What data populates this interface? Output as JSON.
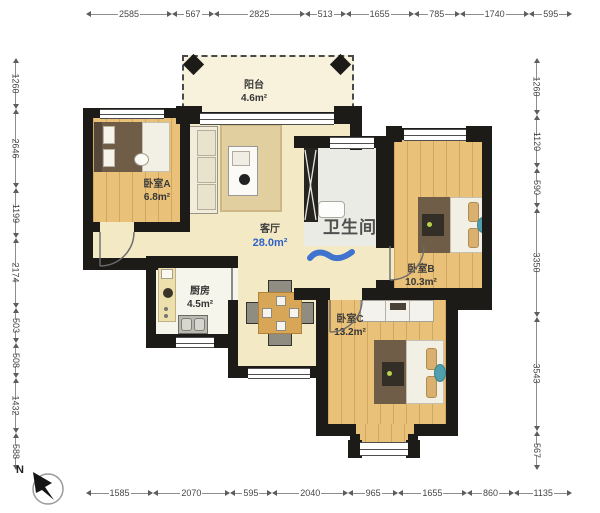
{
  "plan": {
    "rooms": {
      "balcony": {
        "name": "阳台",
        "area": "4.6m²"
      },
      "bedroom_a": {
        "name": "卧室A",
        "area": "6.8m²"
      },
      "living": {
        "name": "客厅",
        "area": "28.0m²"
      },
      "bathroom": {
        "name": "卫生间"
      },
      "bedroom_b": {
        "name": "卧室B",
        "area": "10.3m²"
      },
      "bedroom_c": {
        "name": "卧室C",
        "area": "13.2m²"
      },
      "kitchen": {
        "name": "厨房",
        "area": "4.5m²"
      }
    },
    "compass": {
      "label": "N"
    },
    "rulers": {
      "top": [
        "2585",
        "567",
        "2825",
        "513",
        "1655",
        "785",
        "1740",
        "595"
      ],
      "bottom": [
        "1585",
        "2070",
        "595",
        "2040",
        "965",
        "1655",
        "860",
        "1135"
      ],
      "left": [
        "1260",
        "2646",
        "1199",
        "2174",
        "503",
        "508",
        "1432",
        "588"
      ],
      "right": [
        "1260",
        "1120",
        "590",
        "3350",
        "3543",
        "567"
      ]
    },
    "colors": {
      "wall": "#1d1b18",
      "wood_floor": "#eac178",
      "cream_floor": "#f3e9c4",
      "living_area_text": "#2f62c9",
      "annotation_text": "#4f4f4f",
      "annotation_mark": "#2b66cf"
    }
  }
}
